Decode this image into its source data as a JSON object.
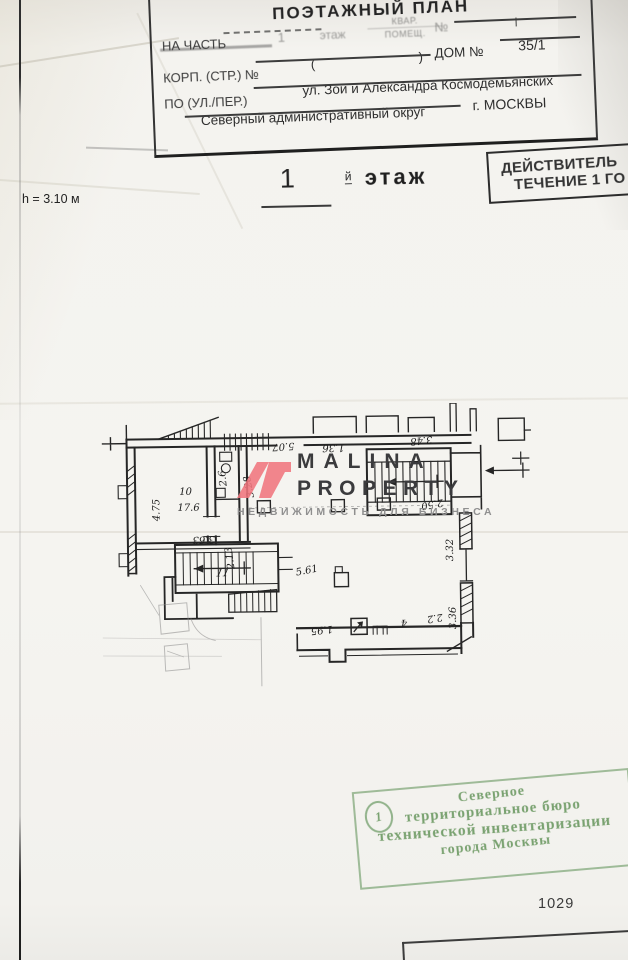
{
  "page": {
    "header": {
      "title": "ПОЭТАЖНЫЙ ПЛАН",
      "na_chast_label": "НА ЧАСТЬ",
      "na_chast_value": "1",
      "etazh_word": "этаж",
      "kvar_label": "КВАР.",
      "pomesch_label": "ПОМЕЩ.",
      "num_label": "№",
      "num_value": "I",
      "korp_label": "КОРП. (СТР.) №",
      "paren_open": "(",
      "paren_close": ")",
      "dom_label": "ДОМ №",
      "dom_value": "35/1",
      "street_label": "ПО (УЛ./ПЕР.)",
      "street_value": "ул. Зои и Александра Космодемьянских",
      "okrug_value": "Северный административный округ",
      "city_value": "г. МОСКВЫ"
    },
    "validity": {
      "line1": "ДЕЙСТВИТЕЛЬ",
      "line2": "ТЕЧЕНИЕ 1 ГО"
    },
    "floor": {
      "number": "1",
      "suffix": "й",
      "word": "этаж",
      "height_note": "h = 3.10 м"
    },
    "watermark": {
      "title_top": "MALINA",
      "title_bottom": "PROPERTY",
      "subtitle": "НЕДВИЖИМОСТЬ ДЛЯ БИЗНЕСА",
      "accent_color": "#f0757d"
    },
    "plan": {
      "room10_number": "10",
      "room10_area": "17.6",
      "room11_number": "11",
      "dims": {
        "left_height": "4.75",
        "room10_width": "3.63",
        "corridor": "2.13",
        "wc": "3.28",
        "wc_small": "2.6",
        "top_center": "5.07",
        "top_right": "1.36",
        "stair_right": "3.48",
        "vestibule": "2.50",
        "wall_upper": "3.32",
        "wall_lower": "3.36",
        "stair_center": "5.61",
        "bottom_left": "1.95",
        "bottom_mid": "4",
        "bottom_right": "2.2"
      }
    },
    "stamp": {
      "badge": "1",
      "line1": "Северное",
      "line2": "территориальное бюро",
      "line3": "технической инвентаризации",
      "line4": "города Москвы",
      "color": "#69975f"
    },
    "page_number": "1029"
  }
}
